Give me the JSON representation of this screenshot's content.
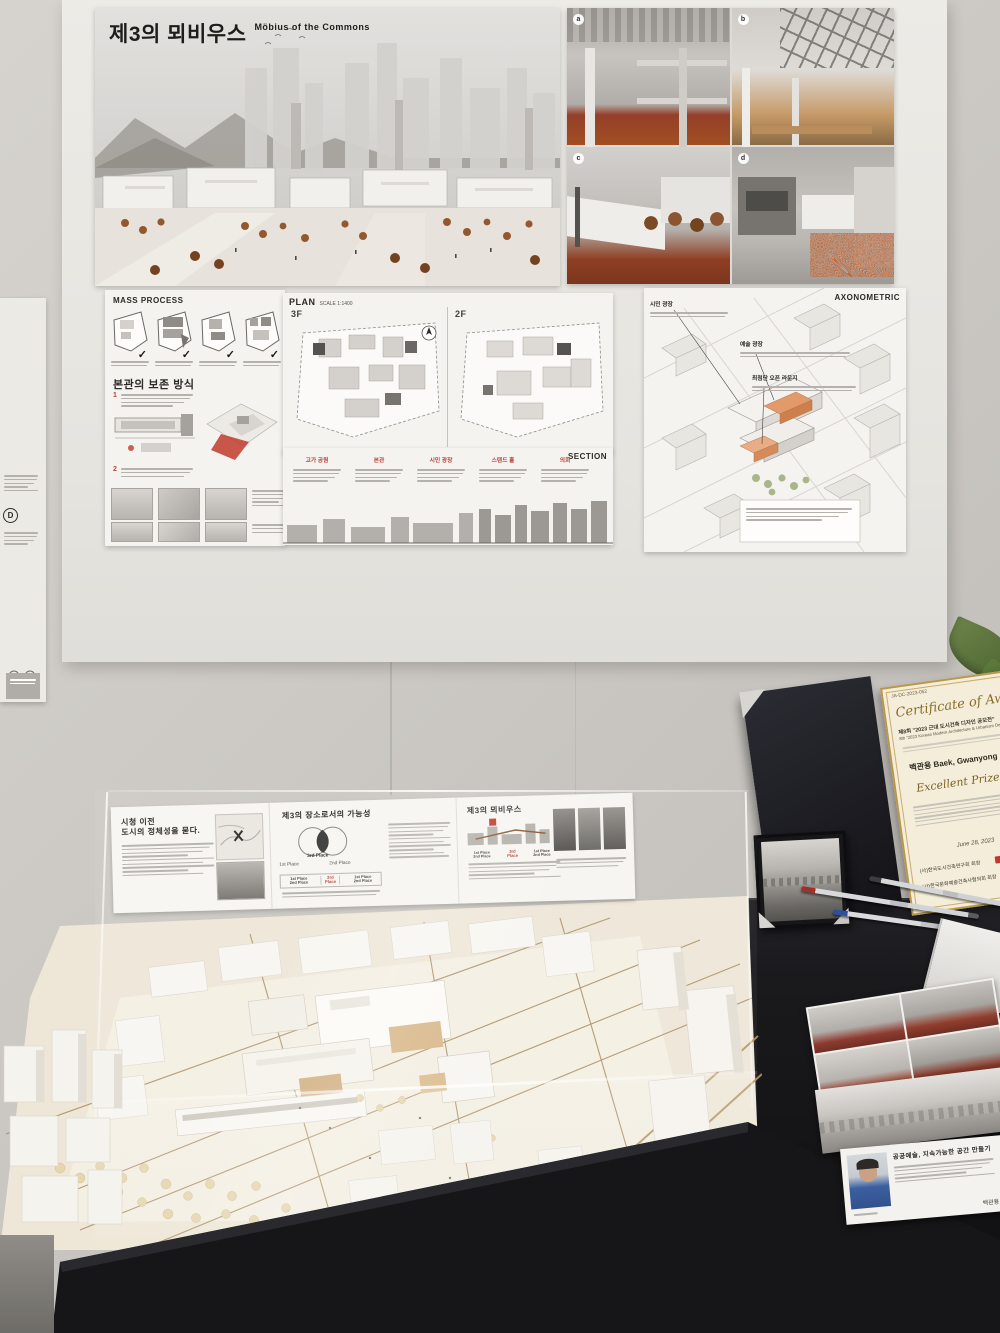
{
  "poster_main": {
    "title_kr": "제3의 뫼비우스",
    "title_en": "Möbius of the Commons"
  },
  "mass_panel": {
    "header": "MASS PROCESS",
    "preserve_title": "본관의 보존 방식",
    "step_marks": [
      "✓",
      "✓",
      "✓",
      "✓"
    ],
    "note_numbers": [
      "1",
      "2"
    ]
  },
  "plan_panel": {
    "header": "PLAN",
    "scale": "SCALE 1:1400",
    "floors": [
      "3F",
      "2F"
    ]
  },
  "section_panel": {
    "header": "SECTION",
    "tags": [
      "고가 공원",
      "본관",
      "시민 광장",
      "스탠드 홀",
      "의회"
    ]
  },
  "axon_panel": {
    "header": "AXONOMETRIC",
    "labels": [
      "시민 광장",
      "예술 광장",
      "최첨단 오픈 라운지"
    ]
  },
  "render_badges": [
    "a",
    "b",
    "c",
    "d"
  ],
  "case_panels": {
    "left_title_1": "시청 이전",
    "left_title_2": "도시의 정체성을 묻다.",
    "center_title": "제3의 장소로서의 가능성",
    "right_title": "제3의 뫼비우스",
    "venn_left": "1st Place",
    "venn_right": "2nd Place",
    "venn_center": "3rd Place",
    "place_table": [
      "1st Place 2nd Place",
      "3rd Place",
      "1st Place 2nd Place"
    ]
  },
  "certificate": {
    "ref": "JA-DC-2023-052",
    "script_title": "Certificate of Aw",
    "line_kr": "제8회 \"2023 근대 도시건축 디자인 공모전\"",
    "line_en": "8th \"2023 Korean Modern Architecture & Urbanism Design\"",
    "recipient": "백관용  Baek, Gwanyong",
    "prize": "Excellent Prize",
    "date": "June 28, 2023",
    "org_line_1": "(사)한국도시건축연구회 회장",
    "org_line_2": "(사)한국문화예술건축사협의회 회장"
  },
  "profile_card": {
    "title": "공공예술, 지속가능한 공간 만들기",
    "name": "백관용"
  },
  "left_strip_badge": "D",
  "accents": {
    "rust_trees": "#9b5a32",
    "interior_orange": "#a9521f",
    "red_label": "#b5433a",
    "certificate_gold": "#b9974a",
    "seal_red": "#c0392b",
    "leaf_green": "#5f7c3c",
    "model_base": "#efe8da"
  }
}
